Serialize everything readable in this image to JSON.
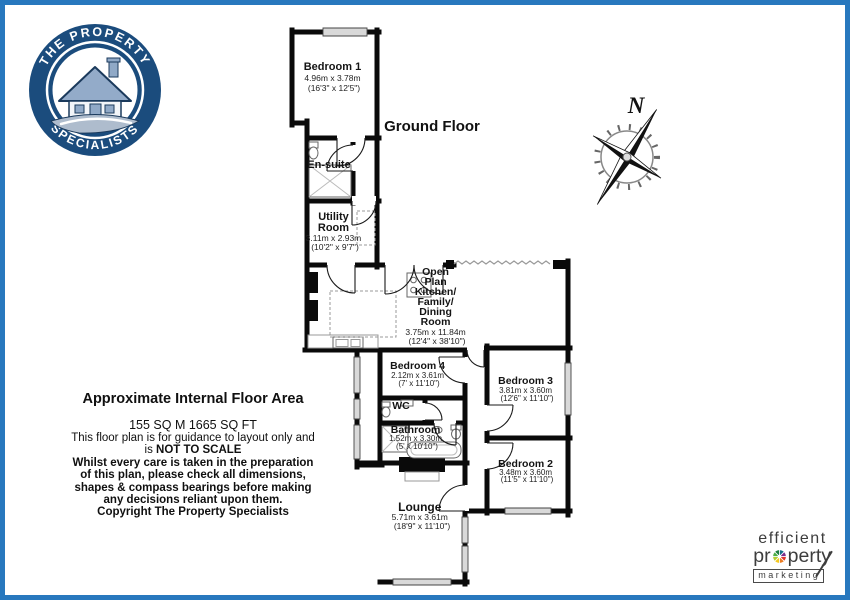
{
  "page": {
    "floor_label": "Ground Floor"
  },
  "compass": {
    "north_label": "N"
  },
  "logo": {
    "arc_top": "THE PROPERTY",
    "arc_bottom": "SPECIALISTS"
  },
  "rooms": {
    "bedroom1": {
      "name": "Bedroom 1",
      "dims_m": "4.96m x 3.78m",
      "dims_ft": "(16'3\" x 12'5\")"
    },
    "ensuite": {
      "name": "En-suite"
    },
    "utility": {
      "line1": "Utility",
      "line2": "Room",
      "dims_m": "3.11m x 2.93m",
      "dims_ft": "(10'2\" x 9'7\")"
    },
    "openplan": {
      "name_lines": [
        "Open",
        "Plan",
        "Kitchen/",
        "Family/",
        "Dining",
        "Room"
      ],
      "dims_m": "3.75m x 11.84m",
      "dims_ft": "(12'4\" x 38'10\")"
    },
    "bedroom4": {
      "name": "Bedroom 4",
      "dims_m": "2.12m x 3.61m",
      "dims_ft": "(7' x 11'10\")"
    },
    "bedroom3": {
      "name": "Bedroom 3",
      "dims_m": "3.81m x 3.60m",
      "dims_ft": "(12'6\" x 11'10\")"
    },
    "wc": {
      "name": "WC"
    },
    "bathroom": {
      "name": "Bathroom",
      "dims_m": "1.52m x 3.30m",
      "dims_ft": "(5' x 10'10\")"
    },
    "bedroom2": {
      "name": "Bedroom 2",
      "dims_m": "3.48m x 3.60m",
      "dims_ft": "(11'5\" x 11'10\")"
    },
    "lounge": {
      "name": "Lounge",
      "dims_m": "5.71m x 3.61m",
      "dims_ft": "(18'9\" x 11'10\")"
    }
  },
  "disclaimer": {
    "heading": "Approximate Internal Floor Area",
    "area": "155 SQ M 1665 SQ FT",
    "line1": "This floor plan is for guidance to layout only and",
    "scale_prefix": "is ",
    "scale_bold": "NOT TO SCALE",
    "line3": "Whilst every care is taken in the preparation",
    "line4": "of this plan, please check all dimensions,",
    "line5": "shapes & compass bearings before making",
    "line6": "any decisions reliant upon them.",
    "line7": "Copyright The Property Specialists"
  },
  "footer": {
    "line1": "efficient",
    "line2_pre": "pr",
    "line2_post": "perty",
    "line3": "marketing"
  },
  "colors": {
    "border_blue": "#2878be",
    "logo_navy": "#1b4c7d",
    "wall_black": "#0a0a0a",
    "window_grey": "#d9d9d9"
  }
}
